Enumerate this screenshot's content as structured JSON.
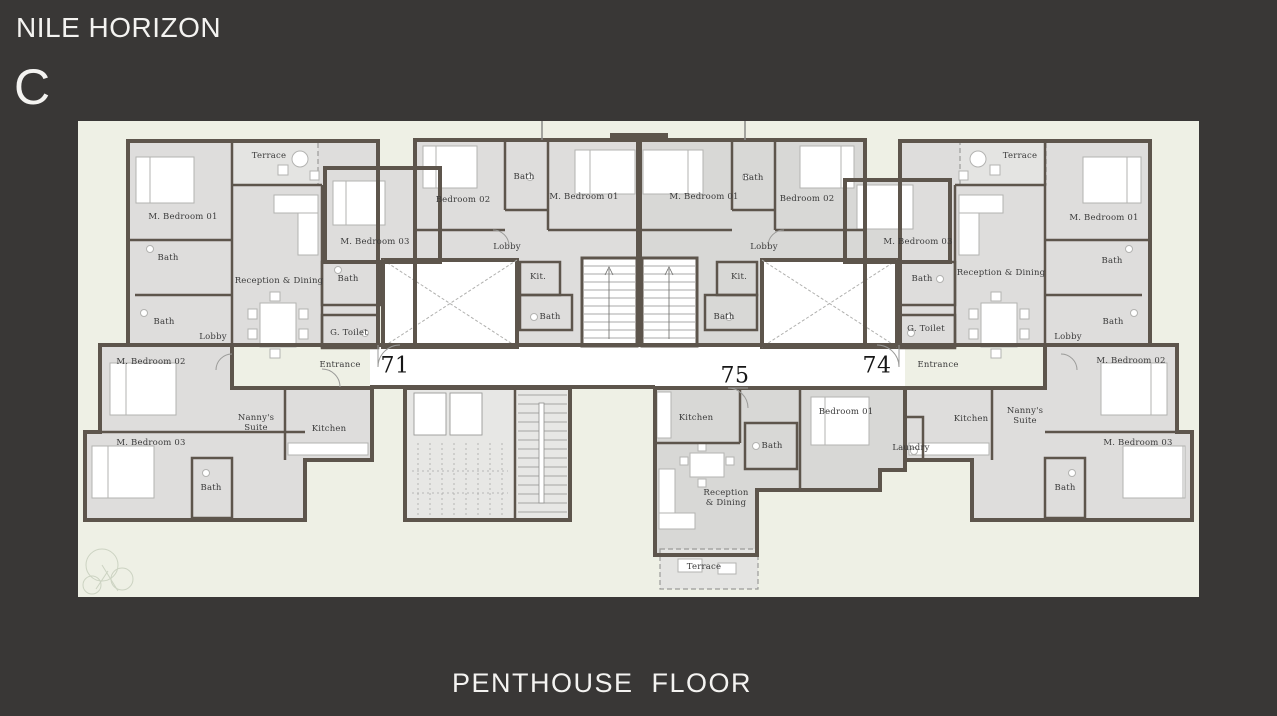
{
  "header": {
    "project_title": "NILE HORIZON",
    "building_letter": "C"
  },
  "footer": {
    "floor_label": "PENTHOUSE  FLOOR"
  },
  "colors": {
    "background": "#393736",
    "plan_background": "#eef0e5",
    "room_fill": "#dedddc",
    "wall": "#5d554c",
    "title_text": "#f4f3f1",
    "label_text": "#3b3b3b"
  },
  "plan": {
    "unit_numbers": [
      {
        "label": "71",
        "x": 317,
        "y": 245
      },
      {
        "label": "75",
        "x": 657,
        "y": 255
      },
      {
        "label": "74",
        "x": 799,
        "y": 245
      }
    ],
    "room_labels": [
      {
        "text": "M. Bedroom 01",
        "x": 105,
        "y": 96
      },
      {
        "text": "Terrace",
        "x": 191,
        "y": 35
      },
      {
        "text": "Bath",
        "x": 90,
        "y": 137
      },
      {
        "text": "Reception & Dining",
        "x": 201,
        "y": 160
      },
      {
        "text": "Bath",
        "x": 86,
        "y": 201
      },
      {
        "text": "Lobby",
        "x": 135,
        "y": 216
      },
      {
        "text": "M. Bedroom 02",
        "x": 73,
        "y": 241
      },
      {
        "text": "G. Toilet",
        "x": 271,
        "y": 212
      },
      {
        "text": "Entrance",
        "x": 262,
        "y": 244
      },
      {
        "text": "M. Bedroom 03",
        "x": 73,
        "y": 322
      },
      {
        "text": "Bath",
        "x": 133,
        "y": 367
      },
      {
        "text": "Nanny's\nSuite",
        "x": 178,
        "y": 302
      },
      {
        "text": "Kitchen",
        "x": 251,
        "y": 308
      },
      {
        "text": "M. Bedroom 03",
        "x": 297,
        "y": 121
      },
      {
        "text": "Bath",
        "x": 270,
        "y": 158
      },
      {
        "text": "Bedroom 02",
        "x": 385,
        "y": 79
      },
      {
        "text": "Bath",
        "x": 446,
        "y": 56
      },
      {
        "text": "M. Bedroom 01",
        "x": 506,
        "y": 76
      },
      {
        "text": "Lobby",
        "x": 429,
        "y": 126
      },
      {
        "text": "Kit.",
        "x": 460,
        "y": 156
      },
      {
        "text": "Bath",
        "x": 472,
        "y": 196
      },
      {
        "text": "M. Bedroom 01",
        "x": 626,
        "y": 76
      },
      {
        "text": "Bath",
        "x": 675,
        "y": 57
      },
      {
        "text": "Bedroom 02",
        "x": 729,
        "y": 78
      },
      {
        "text": "Lobby",
        "x": 686,
        "y": 126
      },
      {
        "text": "Kit.",
        "x": 661,
        "y": 156
      },
      {
        "text": "Bath",
        "x": 646,
        "y": 196
      },
      {
        "text": "M. Bedroom 03",
        "x": 840,
        "y": 121
      },
      {
        "text": "Bath",
        "x": 844,
        "y": 158
      },
      {
        "text": "G. Toilet",
        "x": 848,
        "y": 208
      },
      {
        "text": "Terrace",
        "x": 942,
        "y": 35
      },
      {
        "text": "Reception & Dining",
        "x": 923,
        "y": 152
      },
      {
        "text": "M. Bedroom 01",
        "x": 1026,
        "y": 97
      },
      {
        "text": "Bath",
        "x": 1034,
        "y": 140
      },
      {
        "text": "Bath",
        "x": 1035,
        "y": 201
      },
      {
        "text": "Lobby",
        "x": 990,
        "y": 216
      },
      {
        "text": "M. Bedroom 02",
        "x": 1053,
        "y": 240
      },
      {
        "text": "Entrance",
        "x": 860,
        "y": 244
      },
      {
        "text": "Kitchen",
        "x": 893,
        "y": 298
      },
      {
        "text": "Nanny's\nSuite",
        "x": 947,
        "y": 295
      },
      {
        "text": "Laundry",
        "x": 833,
        "y": 327
      },
      {
        "text": "M. Bedroom 03",
        "x": 1060,
        "y": 322
      },
      {
        "text": "Bath",
        "x": 987,
        "y": 367
      },
      {
        "text": "Kitchen",
        "x": 618,
        "y": 297
      },
      {
        "text": "Bath",
        "x": 694,
        "y": 325
      },
      {
        "text": "Bedroom 01",
        "x": 768,
        "y": 291
      },
      {
        "text": "Reception\n& Dining",
        "x": 648,
        "y": 377
      },
      {
        "text": "Terrace",
        "x": 626,
        "y": 446
      }
    ]
  }
}
